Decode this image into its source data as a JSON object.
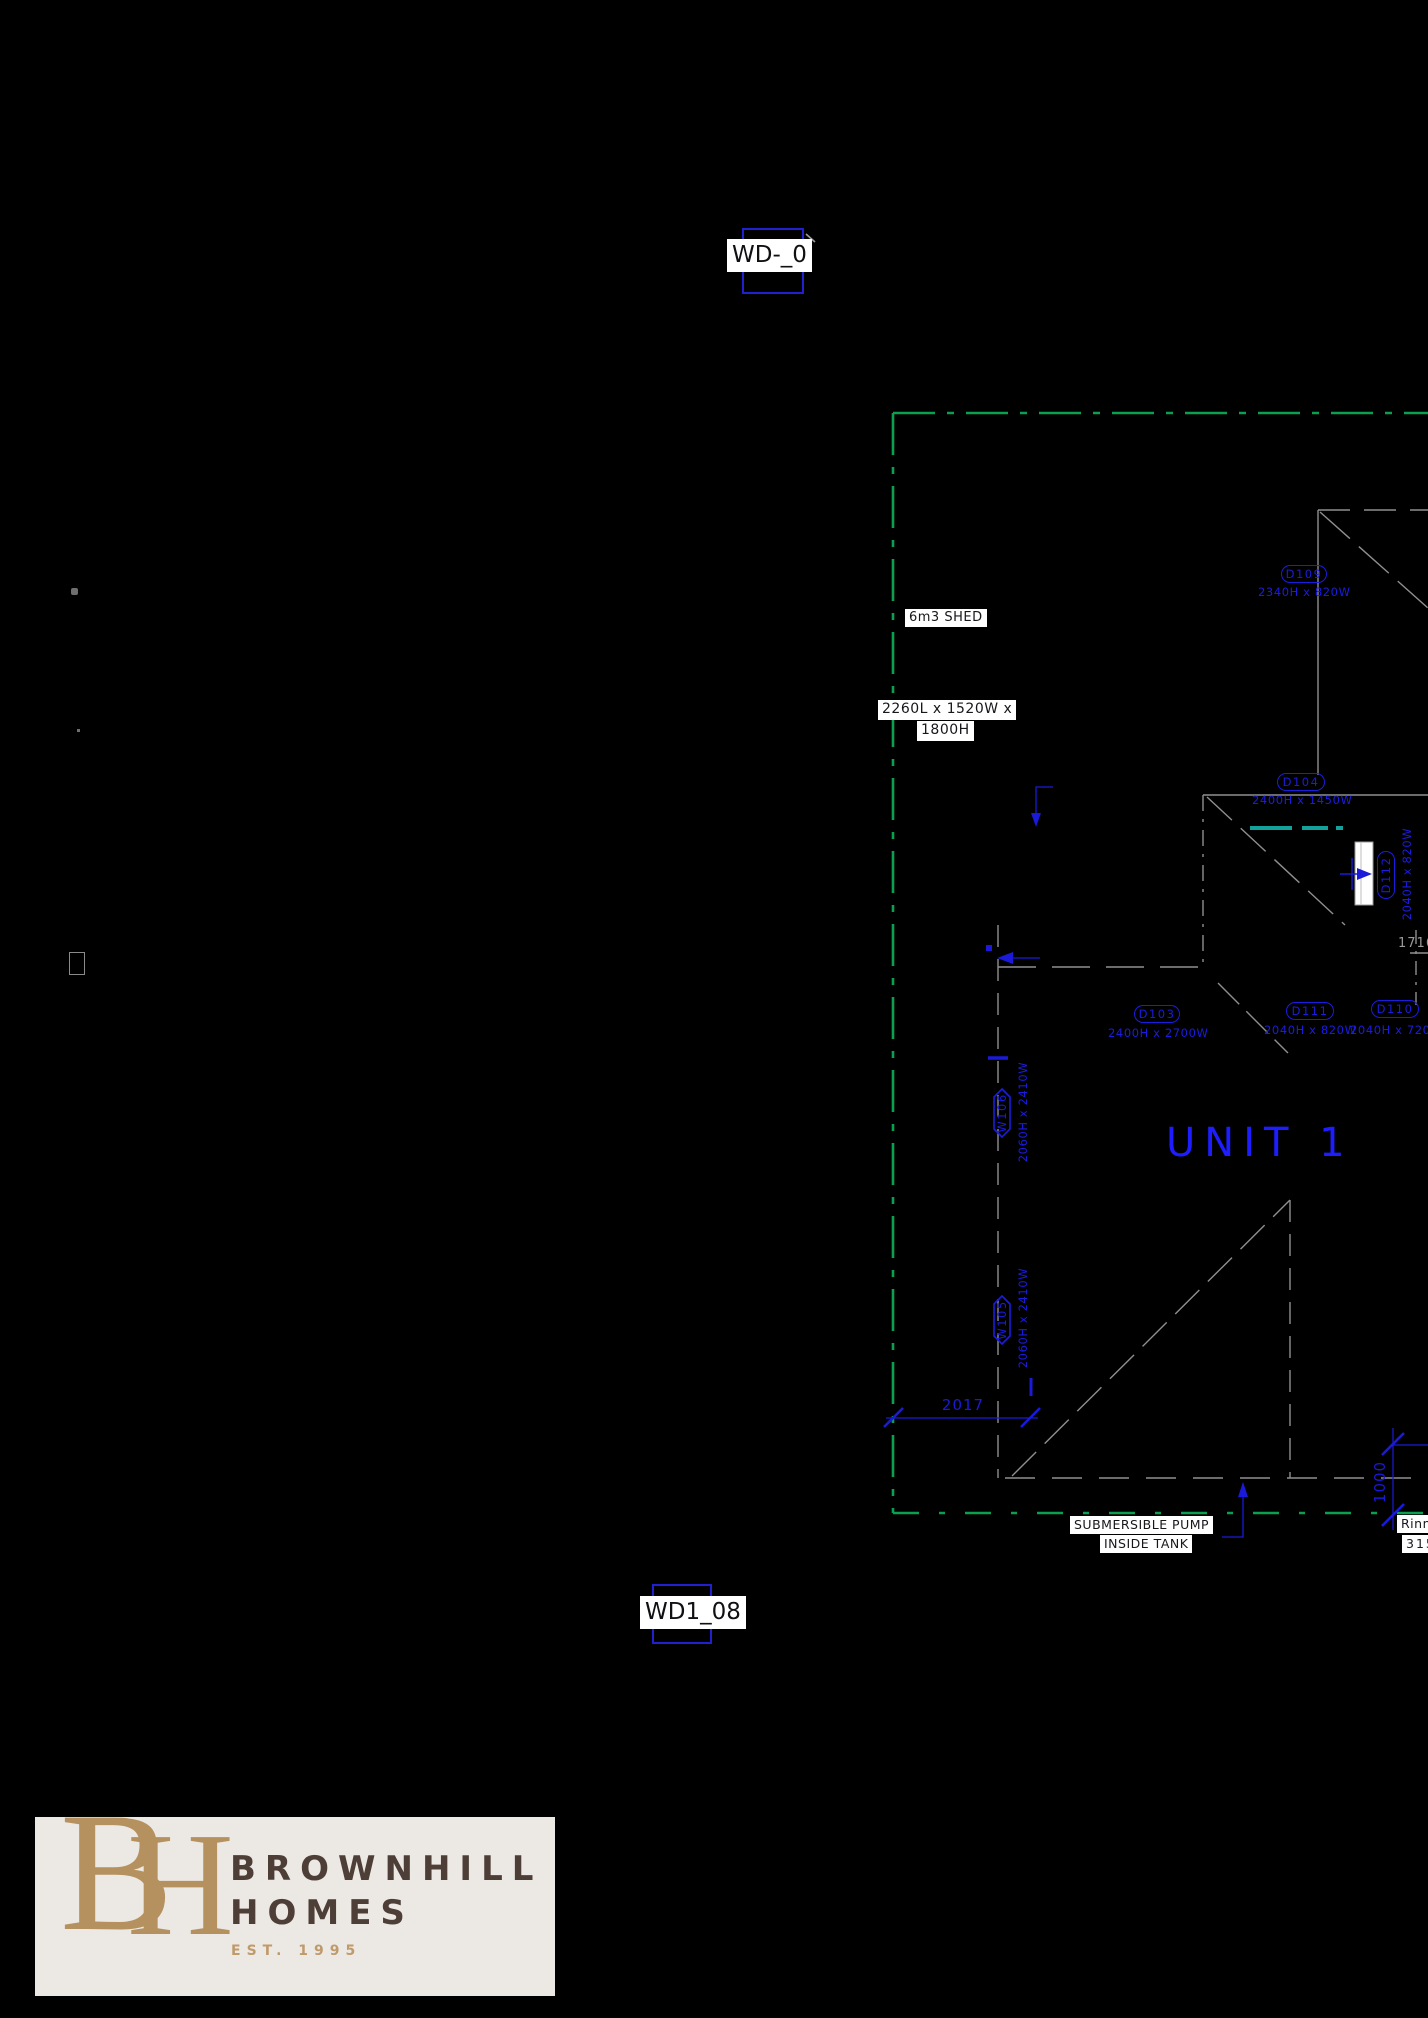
{
  "refs": {
    "top": "WD-_0",
    "bottom": "WD1_08"
  },
  "unit": {
    "label": "UNIT 1"
  },
  "shed": {
    "name": "6m3 SHED",
    "dims_line1": "2260L x 1520W x",
    "dims_line2": "1800H"
  },
  "pump": {
    "line1": "SUBMERSIBLE PUMP",
    "line2": "INSIDE TANK"
  },
  "edge_note": {
    "brand": "Rinnai",
    "number": "315"
  },
  "dims": {
    "front": "2017",
    "rear": "1000",
    "side": "1716"
  },
  "doors": [
    {
      "tag": "D109",
      "size": "2340H x 820W"
    },
    {
      "tag": "D104",
      "size": "2400H x 1450W"
    },
    {
      "tag": "D112",
      "size": "2040H x 820W"
    },
    {
      "tag": "D103",
      "size": "2400H x 2700W"
    },
    {
      "tag": "D111",
      "size": "2040H x 820W"
    },
    {
      "tag": "D110",
      "size": "2040H x 720W"
    }
  ],
  "windows": [
    {
      "tag": "W106",
      "size": "2060H x 2410W"
    },
    {
      "tag": "W105",
      "size": "2060H x 2410W"
    }
  ],
  "logo": {
    "monogram_b": "B",
    "monogram_h": "H",
    "name_line1": "BROWNHILL",
    "name_line2": "HOMES",
    "est": "EST. 1995"
  },
  "colors": {
    "cad_blue": "#1c1ce0",
    "boundary_green": "#0ba04f",
    "window_teal": "#12a29b",
    "line_gray": "#8f8f8f",
    "logo_gold": "#b5915f",
    "logo_brown": "#4d3f37"
  }
}
